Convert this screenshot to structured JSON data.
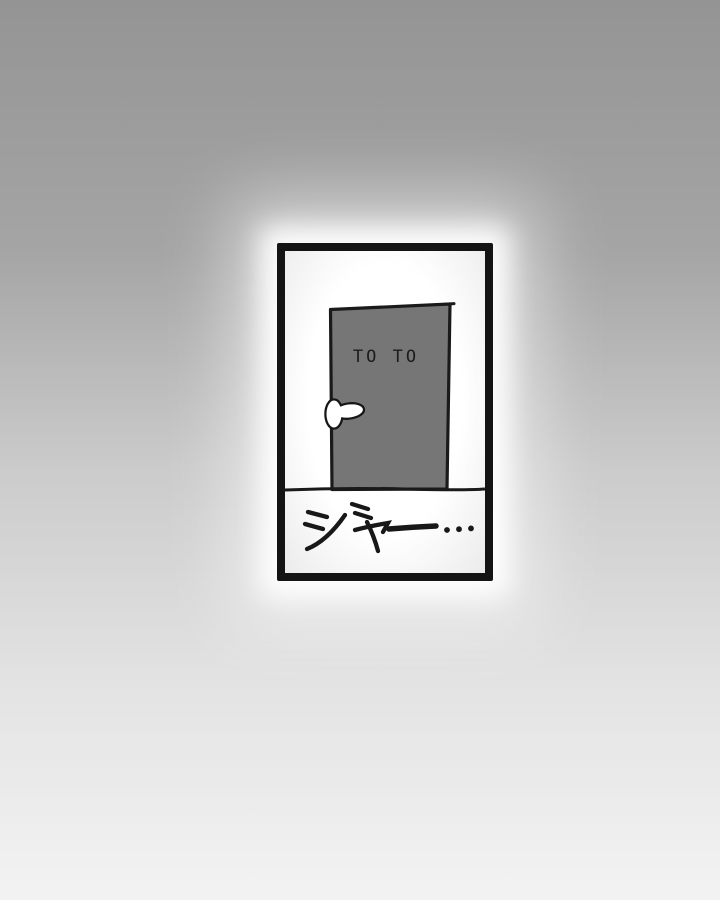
{
  "page": {
    "background": {
      "top_color": "#949494",
      "middle_color": "#cbcbcb",
      "bottom_color": "#f3f3f3"
    },
    "glow_color": "#ffffff"
  },
  "panel": {
    "frame_color": "#141414",
    "interior_color": "#ffffff",
    "ink_color": "#1a1a1a",
    "door": {
      "label": "TO TO",
      "fill_color": "#767676"
    },
    "sound_effect": "ジャー…"
  }
}
